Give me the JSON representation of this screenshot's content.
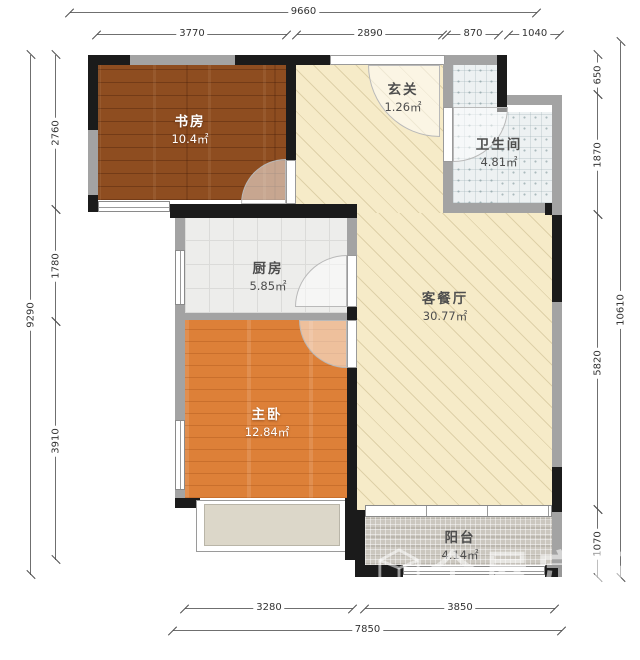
{
  "rooms": {
    "study": {
      "name": "书房",
      "area": "10.4㎡"
    },
    "entry": {
      "name": "玄关",
      "area": "1.26㎡"
    },
    "bathroom": {
      "name": "卫生间",
      "area": "4.81㎡"
    },
    "kitchen": {
      "name": "厨房",
      "area": "5.85㎡"
    },
    "living_dining": {
      "name": "客餐厅",
      "area": "30.77㎡"
    },
    "master_bedroom": {
      "name": "主卧",
      "area": "12.84㎡"
    },
    "balcony": {
      "name": "阳台",
      "area": "4.14㎡"
    }
  },
  "dimensions": {
    "top": {
      "total": "9660",
      "segments": [
        "3770",
        "2890",
        "870",
        "1040"
      ]
    },
    "left": {
      "total": "9290",
      "segments": [
        "2760",
        "1780",
        "3910"
      ]
    },
    "right": {
      "total": "10610",
      "segments": [
        "650",
        "1870",
        "5820",
        "1070"
      ]
    },
    "bottom": {
      "total": "7850",
      "segments": [
        "3280",
        "3850"
      ]
    }
  },
  "watermark": {
    "text": "全屋定配",
    "icon": "cube-logo"
  },
  "colors": {
    "wall_black": "#1b1b1b",
    "wall_gray": "#a3a3a3",
    "study_floor": "#8e4d20",
    "master_floor": "#dd8038",
    "living_floor": "#f6ebc8",
    "kitchen_floor": "#ededeb",
    "bathroom_floor": "#edf1f2",
    "balcony_floor": "#cbc7bf"
  }
}
